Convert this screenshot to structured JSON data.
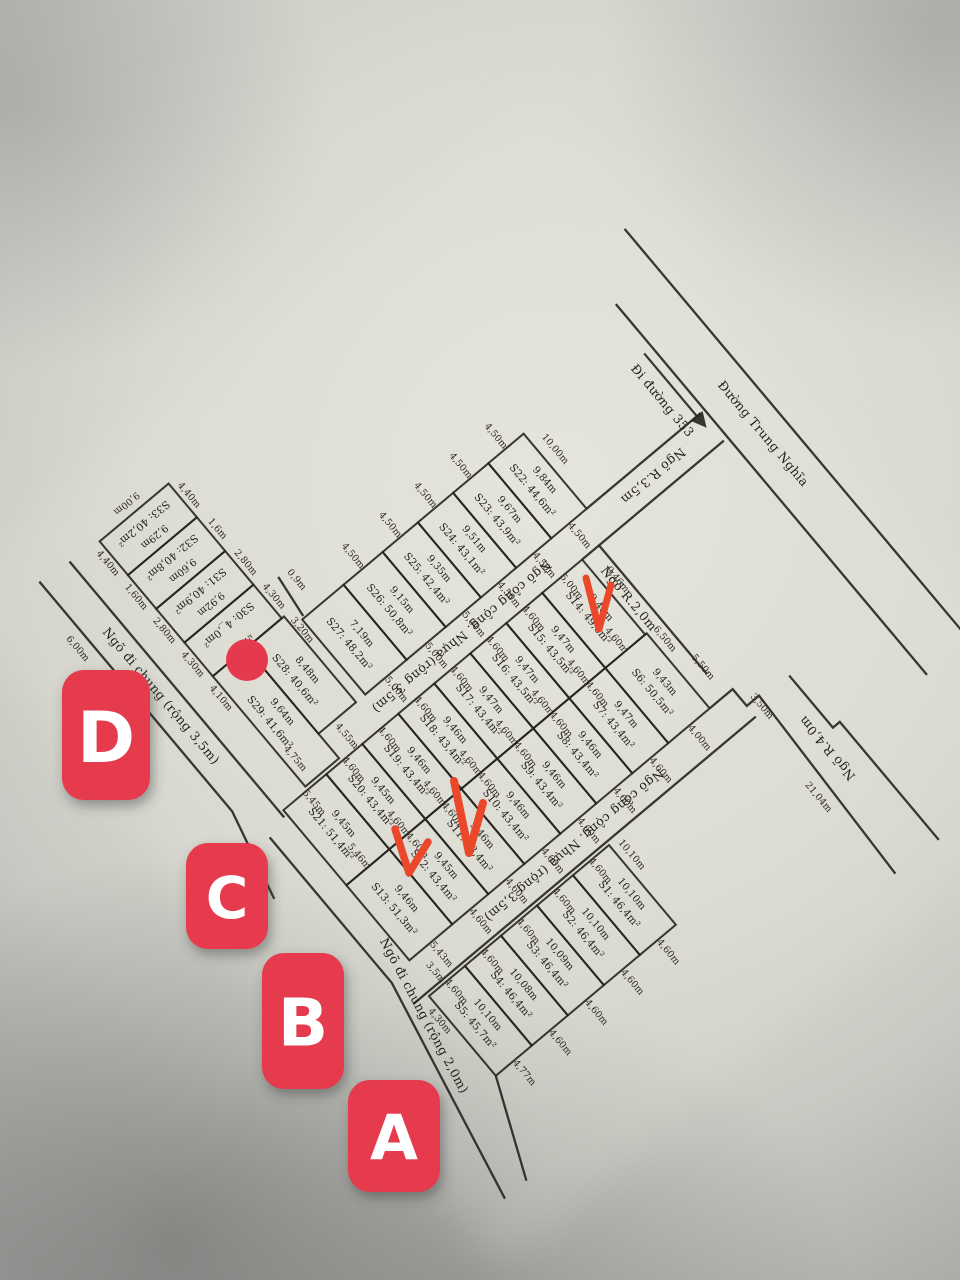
{
  "colors": {
    "marker_red": "#e53a4e",
    "check_red": "#ea472b",
    "ink": "#26241e",
    "paper_light": "#e7e7de",
    "paper_shadow": "#9a9b97"
  },
  "markers": [
    {
      "label": "D"
    },
    {
      "label": "C"
    },
    {
      "label": "B"
    },
    {
      "label": "A"
    }
  ],
  "roads": {
    "route353": "Đi đường 353",
    "trung_nghia": "Đường Trung Nghĩa",
    "ngo_r35": "Ngõ R.3,5m",
    "ngo_r20": "Ngõ R.2,0m",
    "ngo_r40": "Ngõ R.4,0m",
    "street_top": "Ngõ công cộng. Nhựa (rộng 3,5m)",
    "street_bottom": "Ngõ công cộng. Nhựa (rộng 3,5m)",
    "lane_left": "Ngõ đi chung (rộng 3,5m)",
    "lane_bottom": "Ngõ đi chung (rộng 2,0m)"
  },
  "plots": {
    "s22_s27": [
      {
        "label": "S22: 44,6m²",
        "depth": "9,84m",
        "top": "4,50m",
        "bottom": "4,50m"
      },
      {
        "label": "S23: 43,9m²",
        "depth": "9,67m",
        "top": "4,50m",
        "bottom": "4,50m"
      },
      {
        "label": "S24: 43,1m²",
        "depth": "9,51m",
        "top": "4,50m",
        "bottom": "4,50m"
      },
      {
        "label": "S25: 42,4m²",
        "depth": "9,35m",
        "top": "4,50m",
        "bottom": "5,00m"
      },
      {
        "label": "S26: 50,8m²",
        "depth": "9,15m",
        "top": "4,50m",
        "bottom": "5,00m"
      },
      {
        "label": "S27: 48,2m²",
        "depth": "7,19m",
        "top": "",
        "bottom": "5,00m"
      }
    ],
    "s14_s21": [
      {
        "label": "S14: 49,6m²",
        "depth": "9,48m",
        "top": "5,00m",
        "bottom": "4,60m"
      },
      {
        "label": "S15: 43,5m²",
        "depth": "9,47m",
        "top": "4,60m",
        "bottom": "4,60m"
      },
      {
        "label": "S16: 43,5m²",
        "depth": "9,47m",
        "top": "4,60m",
        "bottom": "4,60m"
      },
      {
        "label": "S17: 43,4m²",
        "depth": "9,47m",
        "top": "4,60m",
        "bottom": "4,60m"
      },
      {
        "label": "S18: 43,4m²",
        "depth": "9,46m",
        "top": "4,60m",
        "bottom": "4,60m"
      },
      {
        "label": "S19: 43,4m²",
        "depth": "9,46m",
        "top": "4,60m",
        "bottom": "4,60m"
      },
      {
        "label": "S20: 43,4m²",
        "depth": "9,45m",
        "top": "4,60m",
        "bottom": "4,60m"
      },
      {
        "label": "S21: 51,4m²",
        "depth": "9,45m",
        "top": "5,45m",
        "bottom": "5,46m"
      }
    ],
    "s6_s13": [
      {
        "label": "S6: 50,5m²",
        "depth": "9,43m",
        "top": "",
        "bottom": "4,00m"
      },
      {
        "label": "S7: 43,4m²",
        "depth": "9,47m",
        "top": "4,60m",
        "bottom": "4,60m"
      },
      {
        "label": "S8: 43,4m²",
        "depth": "9,46m",
        "top": "4,60m",
        "bottom": "4,60m"
      },
      {
        "label": "S9: 43,4m²",
        "depth": "9,46m",
        "top": "4,60m",
        "bottom": "4,60m"
      },
      {
        "label": "S10: 43,4m²",
        "depth": "9,46m",
        "top": "4,60m",
        "bottom": "4,60m"
      },
      {
        "label": "S11: 43,4m²",
        "depth": "9,46m",
        "top": "4,60m",
        "bottom": "4,60m"
      },
      {
        "label": "S12: 43,4m²",
        "depth": "9,45m",
        "top": "4,60m",
        "bottom": "4,60m"
      },
      {
        "label": "S13: 51,3m²",
        "depth": "9,46m",
        "top": "",
        "bottom": "5,43m"
      }
    ],
    "s1_s5": [
      {
        "label": "S1: 46,4m²",
        "depth": "10,10m",
        "top": "4,60m",
        "bottom": "4,60m"
      },
      {
        "label": "S2: 46,4m²",
        "depth": "10,10m",
        "top": "4,60m",
        "bottom": "4,60m"
      },
      {
        "label": "S3: 46,4m²",
        "depth": "10,09m",
        "top": "4,60m",
        "bottom": "4,60m"
      },
      {
        "label": "S4: 46,4m²",
        "depth": "10,08m",
        "top": "4,60m",
        "bottom": "4,60m"
      },
      {
        "label": "S5: 45,7m²",
        "depth": "10,10m",
        "top": "4,60m",
        "bottom": "4,77m"
      }
    ],
    "s33_s30": [
      {
        "label": "S33: 40,2m²",
        "depth": "9,29m"
      },
      {
        "label": "S32: 40,8m²",
        "depth": "9,60m"
      },
      {
        "label": "S31: 40,9m²",
        "depth": "9,92m"
      },
      {
        "label": "S30: 4_,0m²",
        "depth": ""
      }
    ],
    "s29": {
      "label": "S29: 41,6m²",
      "depth": "9,64m"
    },
    "s28": {
      "label": "S28: 40,6m²",
      "depth": "8,48m"
    }
  },
  "dims": {
    "misc": [
      "10,00m",
      "9,46m",
      "6,50m",
      "5,50m",
      "3,50m",
      "21,04m",
      "9,00m",
      "4,40m",
      "4,40m",
      "1,6m",
      "1,60m",
      "2,80m",
      "2,80m",
      "4,30m",
      "4,30m",
      "3,20m",
      "4,10m",
      "0,9m",
      "4,75m",
      "5,25m",
      "4,55m",
      "3,5m",
      "10,10m",
      "4,30m",
      "6,00m"
    ]
  }
}
